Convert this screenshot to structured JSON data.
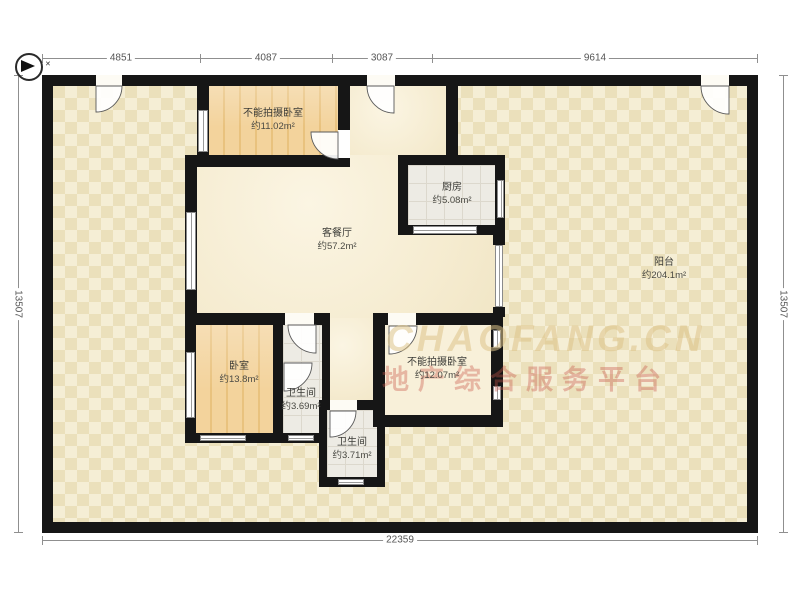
{
  "compass": {
    "mark": "✕"
  },
  "dimensions": {
    "top": [
      "4851",
      "4087",
      "3087",
      "9614"
    ],
    "bottom": "22359",
    "left": "13507",
    "right": "13507"
  },
  "rooms": {
    "bedroom_top": {
      "name": "不能拍摄卧室",
      "area": "约11.02m²"
    },
    "living": {
      "name": "客餐厅",
      "area": "约57.2m²"
    },
    "kitchen": {
      "name": "厨房",
      "area": "约5.08m²"
    },
    "balcony": {
      "name": "阳台",
      "area": "约204.1m²"
    },
    "bedroom_left": {
      "name": "卧室",
      "area": "约13.8m²"
    },
    "bath_upper": {
      "name": "卫生间",
      "area": "约3.69m²"
    },
    "bath_lower": {
      "name": "卫生间",
      "area": "约3.71m²"
    },
    "bedroom_right": {
      "name": "不能拍摄卧室",
      "area": "约12.07m²"
    }
  },
  "watermark": {
    "brand": "CHAOFANG.CN",
    "tagline": "地产综合服务平台"
  },
  "colors": {
    "wall": "#161616",
    "terrace_base": "#f1e8cb",
    "wood": "#f3d39c",
    "accent_watermark": "#c9584a"
  }
}
